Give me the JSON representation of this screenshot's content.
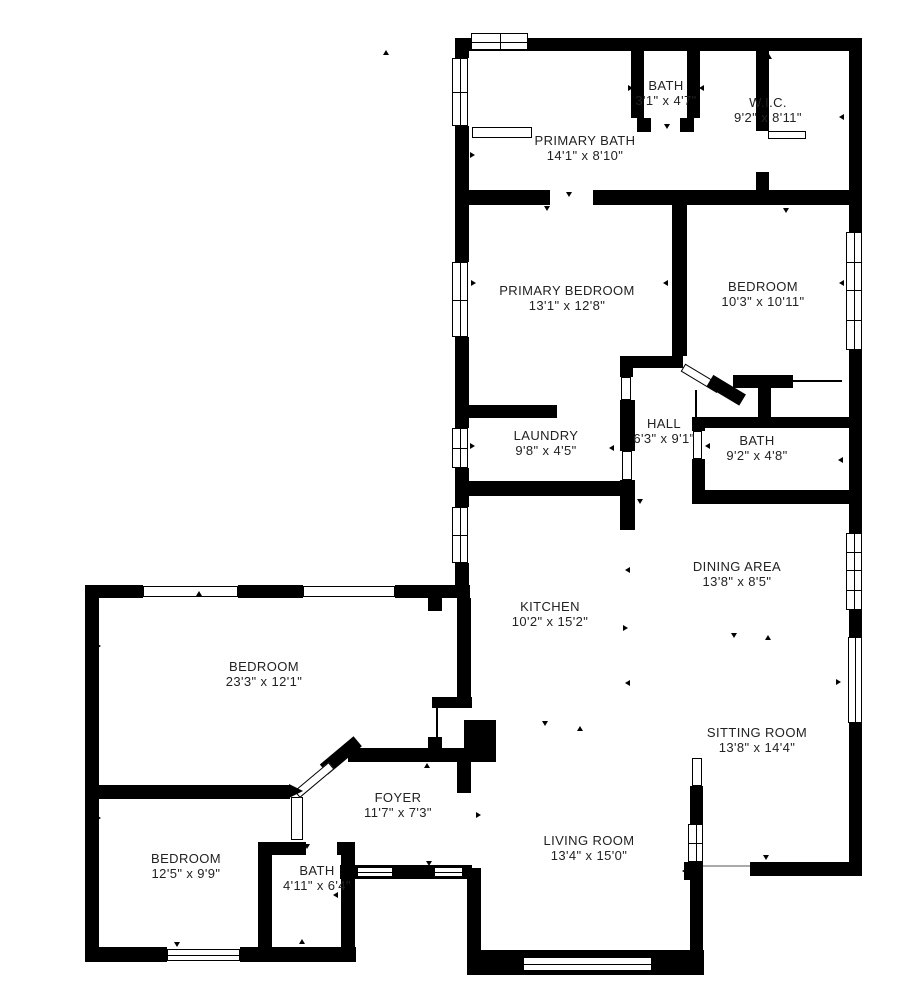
{
  "title": "Residential floor plan",
  "colors": {
    "wall": "#000000",
    "background": "#ffffff",
    "text": "#222222"
  },
  "rooms": [
    {
      "id": "primary-bath",
      "name": "PRIMARY BATH",
      "dims": "14'1\" x 8'10\""
    },
    {
      "id": "bath-top",
      "name": "BATH",
      "dims": "3'1\" x 4'7\""
    },
    {
      "id": "wic",
      "name": "W.I.C.",
      "dims": "9'2\" x 8'11\""
    },
    {
      "id": "primary-bedroom",
      "name": "PRIMARY BEDROOM",
      "dims": "13'1\" x 12'8\""
    },
    {
      "id": "bedroom-ne",
      "name": "BEDROOM",
      "dims": "10'3\" x 10'11\""
    },
    {
      "id": "laundry",
      "name": "LAUNDRY",
      "dims": "9'8\" x 4'5\""
    },
    {
      "id": "hall",
      "name": "HALL",
      "dims": "6'3\" x 9'1\""
    },
    {
      "id": "bath-mid",
      "name": "BATH",
      "dims": "9'2\" x 4'8\""
    },
    {
      "id": "kitchen",
      "name": "KITCHEN",
      "dims": "10'2\" x 15'2\""
    },
    {
      "id": "dining-area",
      "name": "DINING AREA",
      "dims": "13'8\" x 8'5\""
    },
    {
      "id": "bedroom-west",
      "name": "BEDROOM",
      "dims": "23'3\" x 12'1\""
    },
    {
      "id": "sitting-room",
      "name": "SITTING ROOM",
      "dims": "13'8\" x 14'4\""
    },
    {
      "id": "foyer",
      "name": "FOYER",
      "dims": "11'7\" x 7'3\""
    },
    {
      "id": "bedroom-sw",
      "name": "BEDROOM",
      "dims": "12'5\" x 9'9\""
    },
    {
      "id": "bath-sw",
      "name": "BATH",
      "dims": "4'11\" x 6'4\""
    },
    {
      "id": "living-room",
      "name": "LIVING ROOM",
      "dims": "13'4\" x 15'0\""
    }
  ]
}
